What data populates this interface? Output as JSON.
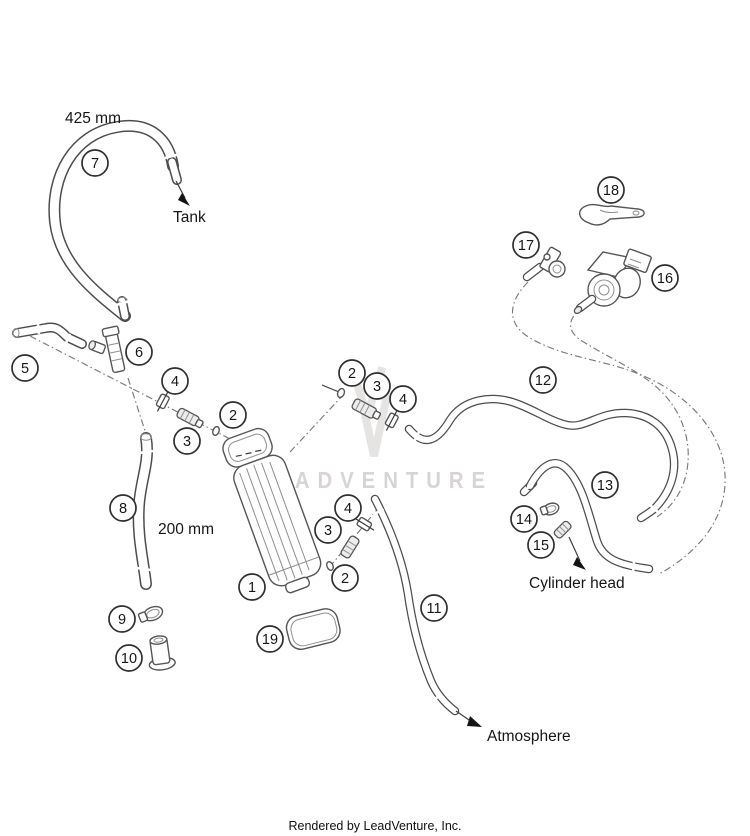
{
  "watermark": {
    "text": "LEADVENTURE",
    "color": "#d8d4d4"
  },
  "footer": {
    "text": "Rendered by LeadVenture, Inc."
  },
  "diagram": {
    "stroke_color": "#4d4d4d",
    "callouts": [
      {
        "n": "1",
        "x": 252,
        "y": 587
      },
      {
        "n": "2",
        "x": 233,
        "y": 415
      },
      {
        "n": "3",
        "x": 187,
        "y": 441
      },
      {
        "n": "4",
        "x": 175,
        "y": 381
      },
      {
        "n": "2",
        "x": 352,
        "y": 373
      },
      {
        "n": "3",
        "x": 377,
        "y": 386
      },
      {
        "n": "4",
        "x": 403,
        "y": 399
      },
      {
        "n": "4",
        "x": 348,
        "y": 508
      },
      {
        "n": "3",
        "x": 328,
        "y": 530
      },
      {
        "n": "2",
        "x": 345,
        "y": 578
      },
      {
        "n": "5",
        "x": 25,
        "y": 368
      },
      {
        "n": "6",
        "x": 139,
        "y": 352
      },
      {
        "n": "7",
        "x": 95,
        "y": 163
      },
      {
        "n": "8",
        "x": 123,
        "y": 508
      },
      {
        "n": "9",
        "x": 122,
        "y": 619
      },
      {
        "n": "10",
        "x": 129,
        "y": 658
      },
      {
        "n": "11",
        "x": 434,
        "y": 608
      },
      {
        "n": "12",
        "x": 543,
        "y": 380
      },
      {
        "n": "13",
        "x": 605,
        "y": 485
      },
      {
        "n": "14",
        "x": 524,
        "y": 519
      },
      {
        "n": "15",
        "x": 541,
        "y": 545
      },
      {
        "n": "16",
        "x": 665,
        "y": 278
      },
      {
        "n": "17",
        "x": 526,
        "y": 245
      },
      {
        "n": "18",
        "x": 611,
        "y": 190
      },
      {
        "n": "19",
        "x": 270,
        "y": 639
      }
    ],
    "labels": [
      {
        "id": "dim-425mm",
        "text": "425 mm",
        "x": 65,
        "y": 123
      },
      {
        "id": "tank",
        "text": "Tank",
        "x": 173,
        "y": 222
      },
      {
        "id": "dim-200mm",
        "text": "200 mm",
        "x": 158,
        "y": 534
      },
      {
        "id": "cylinder-head",
        "text": "Cylinder head",
        "x": 529,
        "y": 588
      },
      {
        "id": "atmosphere",
        "text": "Atmosphere",
        "x": 487,
        "y": 741
      }
    ]
  }
}
